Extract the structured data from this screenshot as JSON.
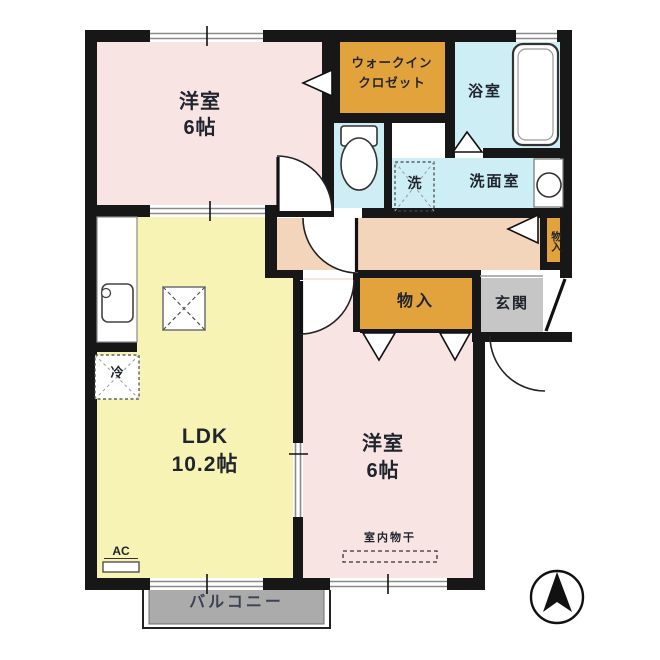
{
  "colors": {
    "wall": "#171717",
    "ink": "#20242e",
    "room_pink": "#f8e4e2",
    "ldk_yellow": "#f7f3b4",
    "closet_orange": "#e3a33c",
    "wet_blue": "#cdeef4",
    "hall_peach": "#f2d5ba",
    "entrance_gray": "#c6c6c6",
    "balcony_gray": "#ababab"
  },
  "rooms": {
    "bedroom_top": {
      "name": "洋室",
      "size": "6帖"
    },
    "walk_in_closet": {
      "line1": "ウォークイン",
      "line2": "クロゼット"
    },
    "bathroom": {
      "label": "浴室"
    },
    "washroom": {
      "label": "洗面室"
    },
    "washer": {
      "label": "洗"
    },
    "hall_storage": {
      "label": "物入"
    },
    "entrance": {
      "label": "玄関"
    },
    "bedroom2_storage": {
      "label": "物入"
    },
    "ldk": {
      "name": "LDK",
      "size": "10.2帖"
    },
    "bedroom_bottom": {
      "name": "洋室",
      "size": "6帖"
    },
    "balcony": {
      "label": "バルコニー"
    }
  },
  "annotations": {
    "fridge": "冷",
    "ac_unit": "AC",
    "indoor_drying": "室内物干"
  },
  "icons": {
    "compass": "north-arrow"
  }
}
